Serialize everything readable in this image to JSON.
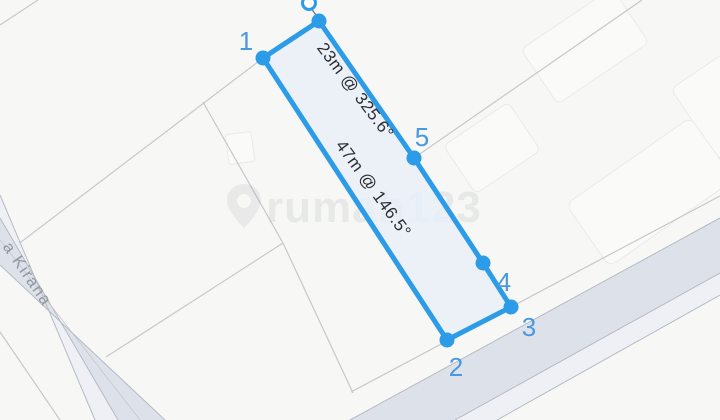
{
  "map": {
    "street_label": "a Kirana",
    "watermark_text": "rumah123",
    "background_color": "#f7f7f5",
    "road_surface_color": "#dde2ea",
    "road_strip_color": "#eef0f5",
    "road_edge_color": "#b6bac2",
    "parcel_line_color": "#c6c8cc",
    "building_fill_color": "#fafaf9"
  },
  "measurement_tool": {
    "polygon_color": "#2d9ce8",
    "polygon_fill_color": "#e8eff8",
    "vertex_labels": {
      "v1": "1",
      "v2": "2",
      "v3": "3",
      "v4": "4",
      "v5": "5"
    },
    "edge_annotations": {
      "segment_5_6": "23m @ 325.6°",
      "segment_1_2": "47m @ 146.5°"
    }
  }
}
